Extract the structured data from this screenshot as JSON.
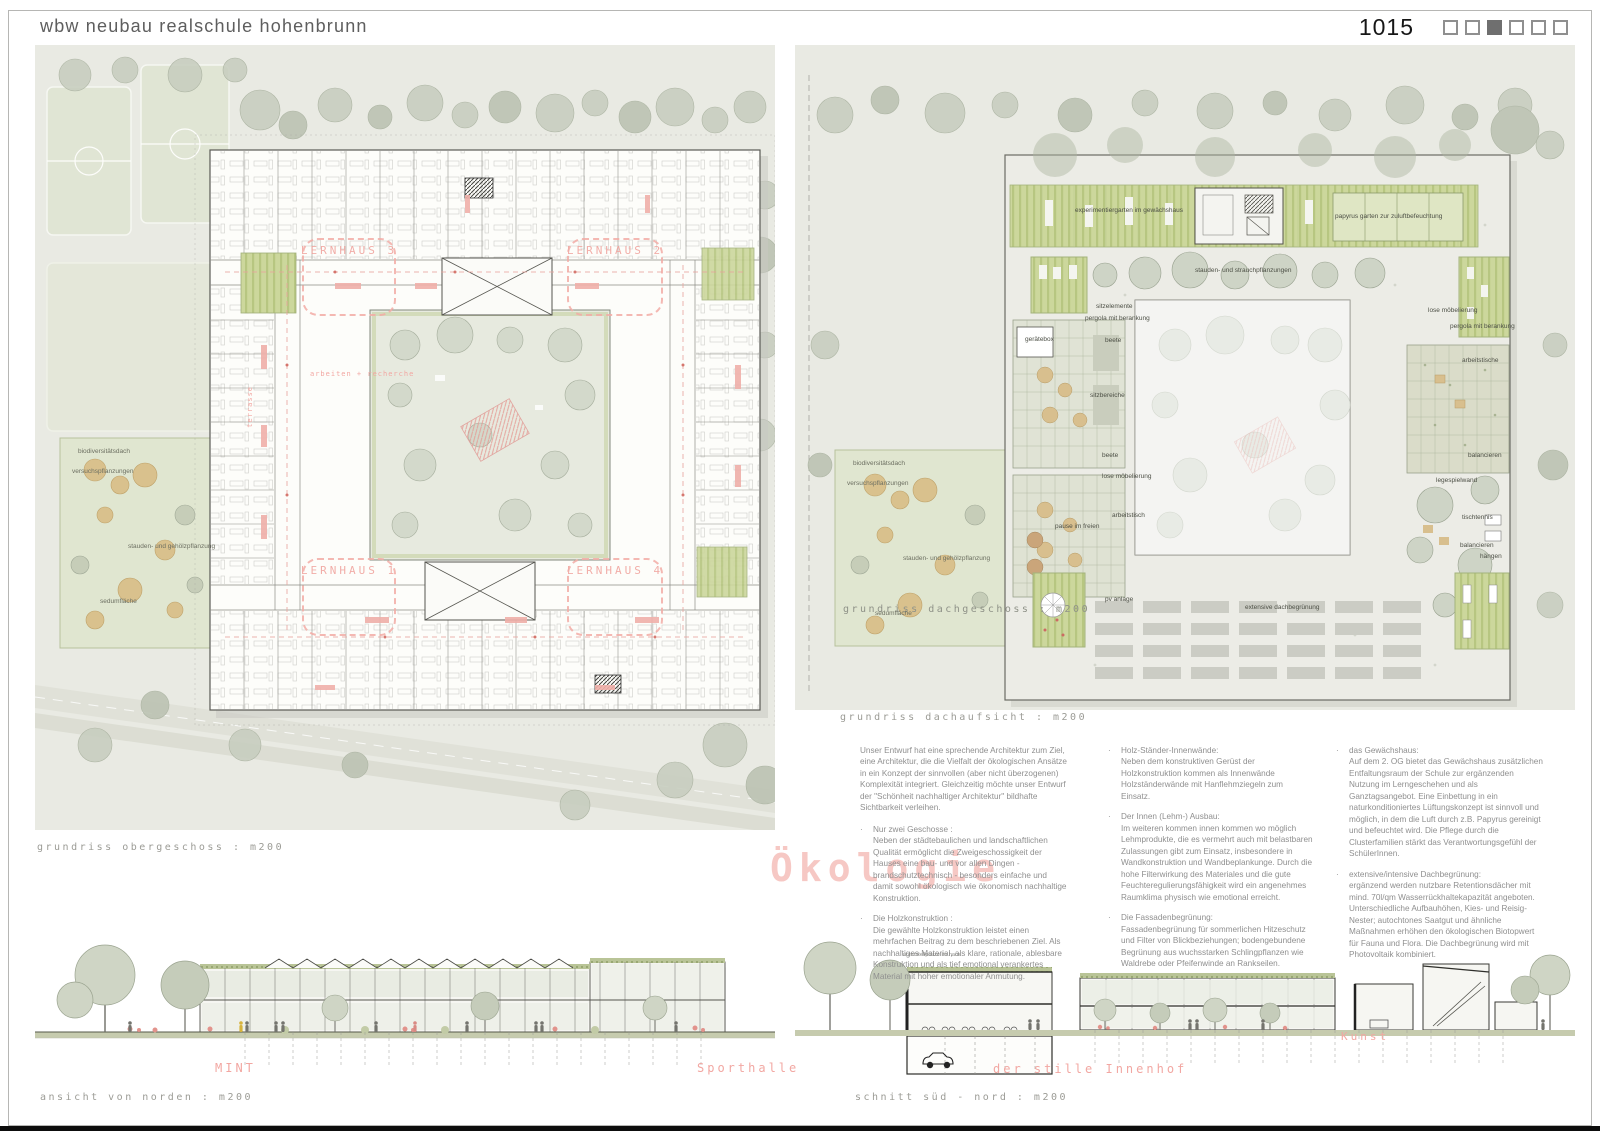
{
  "header": {
    "title": "wbw neubau realschule hohenbrunn",
    "entry_number": "1015",
    "pagination": {
      "total_squares": 6,
      "active_square": 3
    }
  },
  "watermark": "Ökologie",
  "colors": {
    "accent_pink": "#f2a7a2",
    "plan_green": "#ccd79c",
    "site_background": "#e9eae3"
  },
  "floor_plan": {
    "caption": "grundriss obergeschoss : m200",
    "lernhaus_labels": [
      "LERNHAUS 3",
      "LERNHAUS 2",
      "LERNHAUS 1",
      "LERNHAUS 4"
    ],
    "room_labels": [
      "arbeiten + recherche",
      "terrasse"
    ]
  },
  "site_garden": {
    "annotations": [
      "biodiversitätsdach",
      "versuchspflanzungen",
      "stauden- und gehölzpflanzung",
      "sedumfläche"
    ]
  },
  "roof_plan": {
    "caption": "grundriss dachaufsicht : m200",
    "inset_caption": "grundriss dachgeschoss : m200",
    "annotations": [
      "experimentiergarten im gewächshaus",
      "papyrus garten zur zuluftbefeuchtung",
      "stauden- und strauchpflanzungen",
      "sitzelemente",
      "pergola mit berankung",
      "gerätebox",
      "beete",
      "sitzbereiche",
      "beete",
      "lose möbelierung",
      "arbeitstisch",
      "pause im freien",
      "lose möbelierung",
      "pergola mit berankung",
      "arbeitstische",
      "balancieren",
      "legespielwand",
      "tischtennis",
      "balancieren",
      "hängen",
      "pv anlage",
      "extensive dachbegrünung"
    ]
  },
  "elevation": {
    "caption": "ansicht von norden : m200",
    "labels": [
      "MINT",
      "Sporthalle"
    ]
  },
  "section": {
    "caption": "schnitt süd - nord : m200",
    "labels": [
      "der stille Innenhof",
      "Kunst",
      "unterstellplätze im haus"
    ]
  },
  "text_columns": {
    "col1": {
      "intro": "Unser Entwurf hat eine sprechende Architektur zum Ziel, eine Architektur, die die Vielfalt der ökologischen Ansätze in ein Konzept der sinnvollen (aber nicht überzogenen) Komplexität integriert. Gleichzeitig möchte unser Entwurf der \"Schönheit nachhaltiger Architektur\" bildhafte Sichtbarkeit verleihen.",
      "items": [
        {
          "title": "Nur zwei Geschosse :",
          "body": "Neben der städtebaulichen und landschaftlichen Qualität ermöglicht die Zweigeschossigkeit der Hauses eine bau- und vor allen Dingen - brandschutztechnisch - besonders einfache und damit sowohl ökologisch wie ökonomisch nachhaltige Konstruktion."
        },
        {
          "title": "Die Holzkonstruktion :",
          "body": "Die gewählte Holzkonstruktion leistet einen mehrfachen Beitrag zu dem beschriebenen Ziel. Als nachhaltiges Material, als klare, rationale, ablesbare Konstruktion und als tief emotional verankertes Material mit hoher emotionaler Anmutung."
        }
      ]
    },
    "col2": {
      "items": [
        {
          "title": "Holz-Ständer-Innenwände:",
          "body": "Neben dem konstruktiven Gerüst der Holzkonstruktion kommen als Innenwände Holzständerwände mit Hanflehmziegeln zum Einsatz."
        },
        {
          "title": "Der Innen (Lehm-) Ausbau:",
          "body": "Im weiteren kommen innen kommen wo möglich Lehmprodukte, die es vermehrt auch mit belastbaren Zulassungen gibt zum Einsatz, insbesondere in Wandkonstruktion und Wandbeplankunge. Durch die hohe Filterwirkung des Materiales und die gute Feuchteregulierungsfähigkeit wird ein angenehmes Raumklima physisch wie emotional erreicht."
        },
        {
          "title": "Die Fassadenbegrünung:",
          "body": "Fassadenbegrünung für sommerlichen Hitzeschutz und Filter von Blickbeziehungen; bodengebundene Begrünung aus wuchsstarken Schlingpflanzen wie Waldrebe oder Pfeifenwinde an Rankseilen."
        }
      ]
    },
    "col3": {
      "items": [
        {
          "title": "das Gewächshaus:",
          "body": "Auf dem 2. OG bietet das Gewächshaus zusätzlichen Entfaltungsraum der Schule zur ergänzenden Nutzung im Lerngeschehen und als Ganztagsangebot. Eine Einbettung in ein naturkonditioniertes Lüftungskonzept ist sinnvoll und möglich, in dem die Luft durch z.B. Papyrus gereinigt und befeuchtet wird. Die Pflege durch die Clusterfamilien stärkt das Verantwortungsgefühl der SchülerInnen."
        },
        {
          "title": "extensive/intensive Dachbegrünung:",
          "body": "ergänzend werden nutzbare Retentionsdächer mit mind. 70l/qm Wasserrückhaltekapazität angeboten. Unterschiedliche Aufbauhöhen, Kies- und Reisig-Nester; autochtones Saatgut und ähnliche Maßnahmen erhöhen den ökologischen Biotopwert für Fauna und Flora. Die Dachbegrünung wird mit Photovoltaik kombiniert."
        }
      ]
    }
  }
}
